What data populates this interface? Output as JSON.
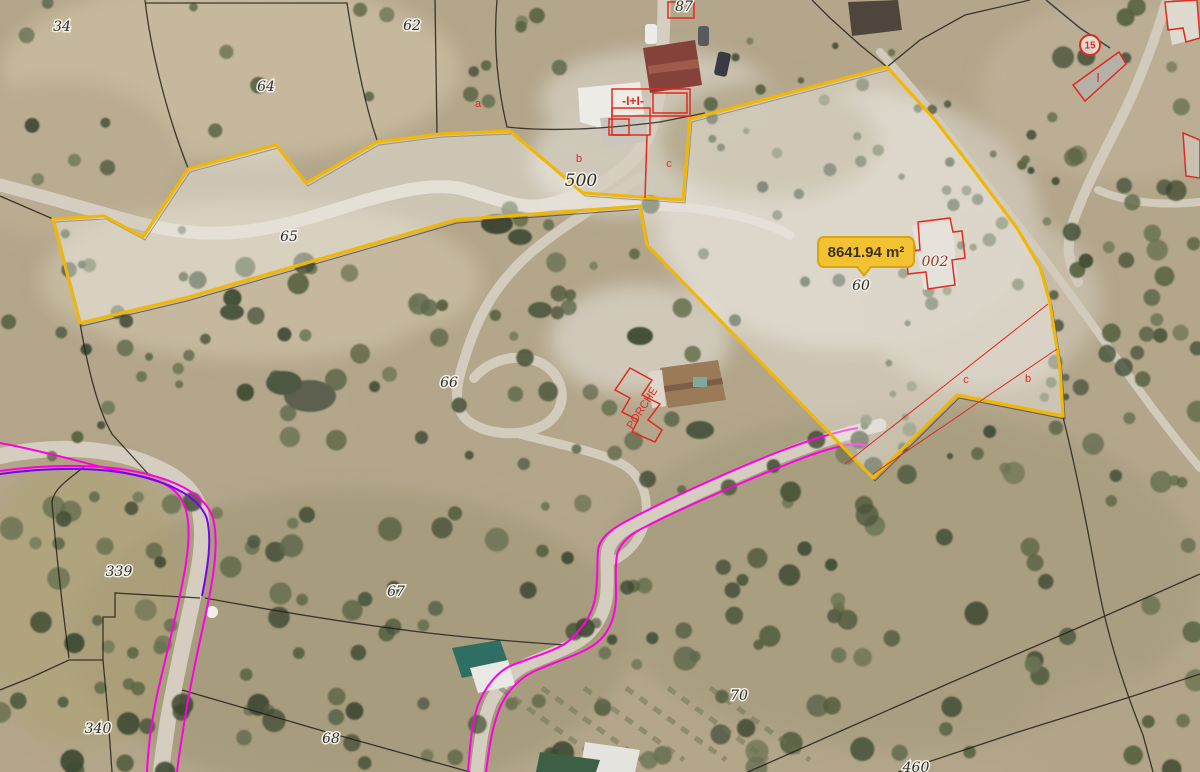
{
  "map": {
    "area_badge": {
      "text": "8641.94 m²"
    },
    "parcel_labels": [
      {
        "text": "34",
        "x": 62,
        "y": 31
      },
      {
        "text": "64",
        "x": 266,
        "y": 91
      },
      {
        "text": "62",
        "x": 412,
        "y": 30
      },
      {
        "text": "87",
        "x": 684,
        "y": 11
      },
      {
        "text": "65",
        "x": 289,
        "y": 241
      },
      {
        "text": "500",
        "x": 581,
        "y": 186,
        "size": 17
      },
      {
        "text": "60",
        "x": 861,
        "y": 290
      },
      {
        "text": "66",
        "x": 449,
        "y": 387
      },
      {
        "text": "67",
        "x": 396,
        "y": 596
      },
      {
        "text": "339",
        "x": 119,
        "y": 576
      },
      {
        "text": "340",
        "x": 98,
        "y": 733
      },
      {
        "text": "68",
        "x": 331,
        "y": 743
      },
      {
        "text": "70",
        "x": 739,
        "y": 700
      },
      {
        "text": "460",
        "x": 916,
        "y": 772
      }
    ],
    "annotation_labels": [
      {
        "text": "a",
        "x": 478,
        "y": 107
      },
      {
        "text": "b",
        "x": 579,
        "y": 162
      },
      {
        "text": "c",
        "x": 669,
        "y": 167
      },
      {
        "text": "-I+I-",
        "x": 633,
        "y": 105,
        "size": 12,
        "bold": true
      },
      {
        "text": "c",
        "x": 966,
        "y": 383
      },
      {
        "text": "b",
        "x": 1028,
        "y": 382
      },
      {
        "text": "I",
        "x": 1098,
        "y": 82,
        "size": 13
      },
      {
        "text": "PORCHE",
        "x": 645,
        "y": 410,
        "rotate": -57
      },
      {
        "text": "002",
        "x": 935,
        "y": 266,
        "halo": true,
        "size": 14
      }
    ],
    "markers": [
      {
        "text": "15",
        "x": 1090,
        "y": 45
      }
    ],
    "colors": {
      "parcel_outline": "#F0B70A",
      "badge_fill": "#F3C233",
      "badge_border": "#D8A311",
      "magenta": "#FF00E1",
      "violet": "#7B00F2",
      "annotation_red": "#DF2B20",
      "boundary_black": "#24211c"
    }
  }
}
